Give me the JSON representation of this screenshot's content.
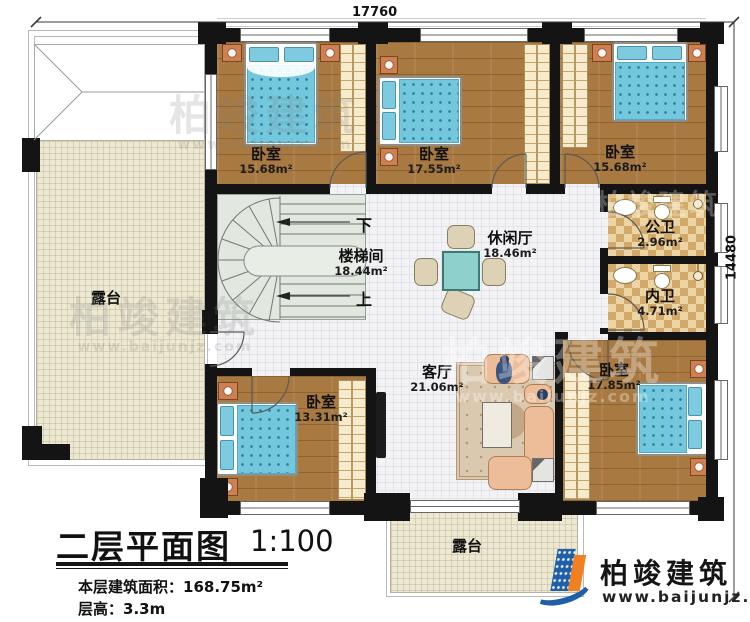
{
  "dimensions": {
    "top": "17760",
    "right": "14480"
  },
  "rooms": [
    {
      "name": "卧室",
      "area": "15.68m²"
    },
    {
      "name": "卧室",
      "area": "17.55m²"
    },
    {
      "name": "卧室",
      "area": "15.68m²"
    },
    {
      "name": "楼梯间",
      "area": "18.44m²"
    },
    {
      "name": "休闲厅",
      "area": "18.46m²"
    },
    {
      "name": "公卫",
      "area": "2.96m²"
    },
    {
      "name": "内卫",
      "area": "4.71m²"
    },
    {
      "name": "客厅",
      "area": "21.06m²"
    },
    {
      "name": "卧室",
      "area": "13.31m²"
    },
    {
      "name": "卧室",
      "area": "17.85m²"
    },
    {
      "name": "露台"
    },
    {
      "name": "露台"
    }
  ],
  "stairs": {
    "down": "下",
    "up": "上"
  },
  "title_block": {
    "title": "二层平面图",
    "scale": "1:100",
    "area_label": "本层建筑面积：",
    "area_value": "168.75m²",
    "height_label": "层高：",
    "height_value": "3.3m"
  },
  "logo": {
    "name": "柏竣建筑",
    "website": "www.baijunjz.com"
  },
  "watermark": {
    "name": "柏竣建筑",
    "url": "www.baijunjz.com"
  },
  "colors": {
    "wall": "#141414",
    "wood_floor": "#a87a42",
    "mattress_blue": "#74c8de",
    "bath_checker": "#d2a968",
    "balcony": "#ece8d2",
    "logo_blue": "#1f5fa8",
    "logo_orange": "#f08020"
  }
}
